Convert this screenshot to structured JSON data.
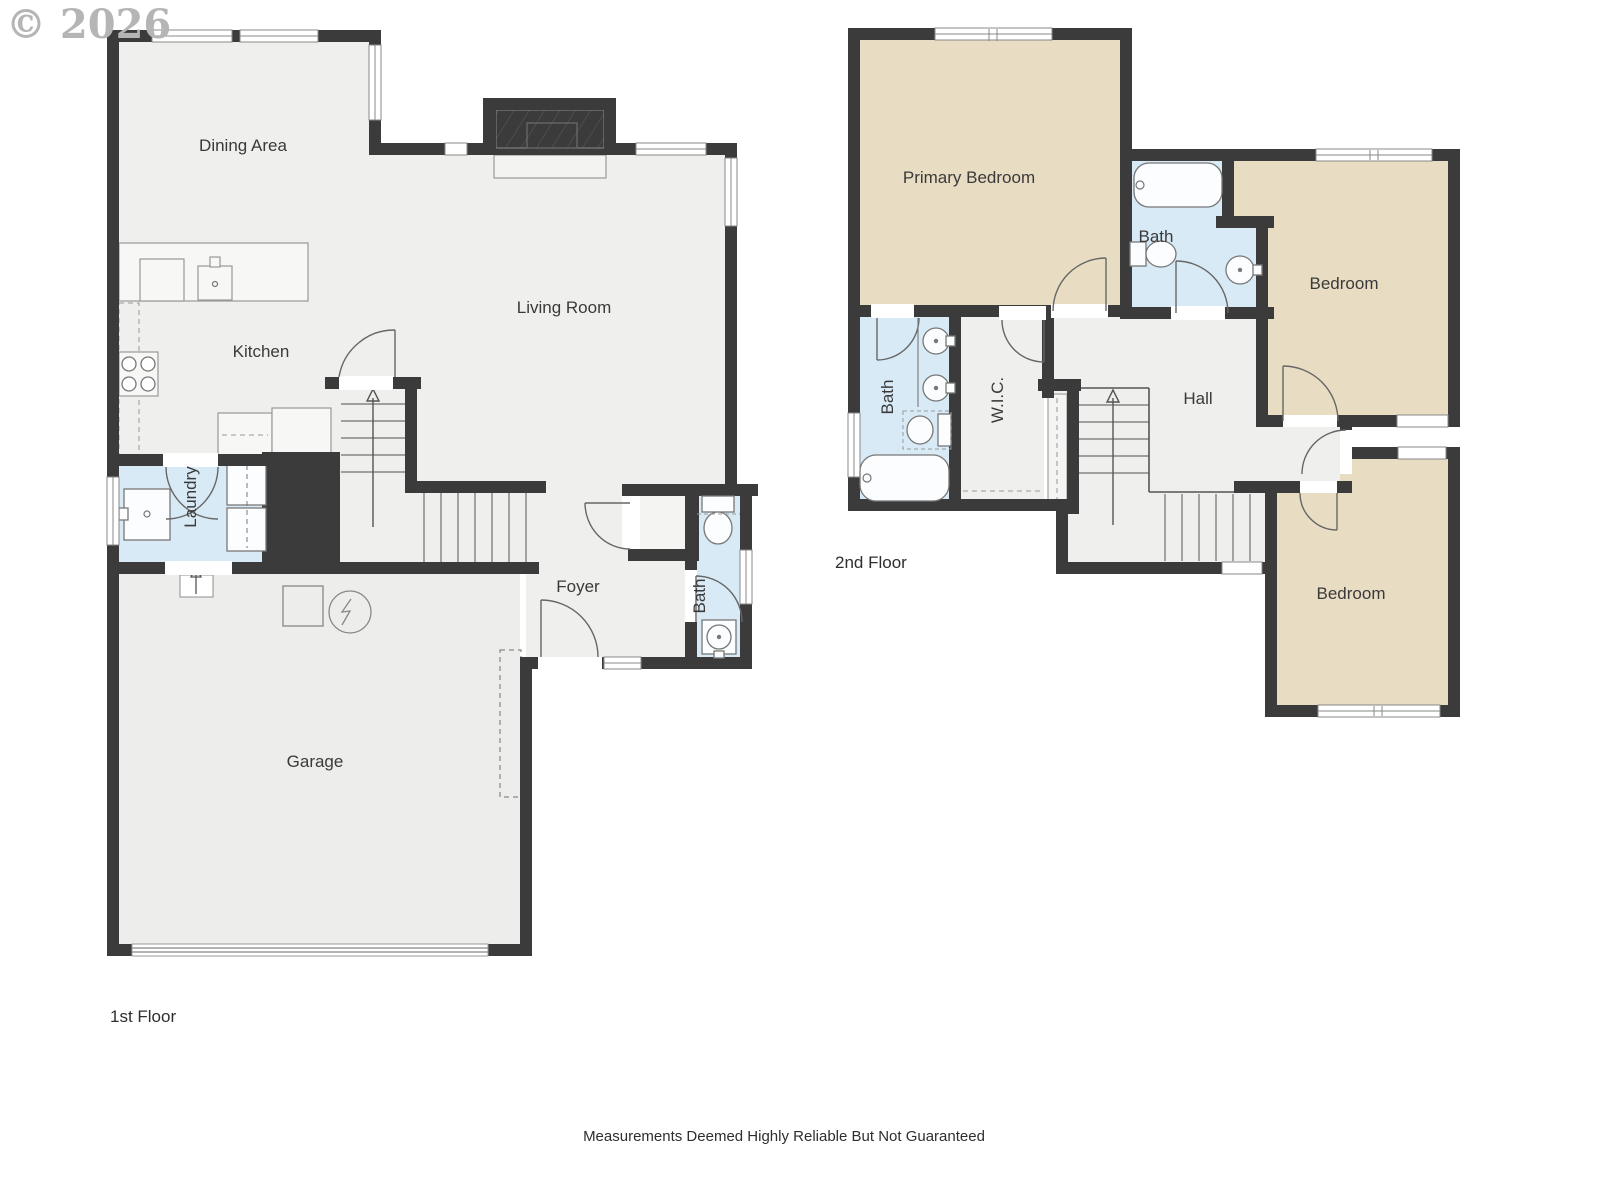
{
  "copyright": "© 2026",
  "floors": {
    "floor1": {
      "label": "1st Floor",
      "rooms": {
        "dining": "Dining Area",
        "kitchen": "Kitchen",
        "living": "Living Room",
        "laundry": "Laundry",
        "foyer": "Foyer",
        "bath": "Bath",
        "garage": "Garage"
      }
    },
    "floor2": {
      "label": "2nd Floor",
      "rooms": {
        "primary": "Primary Bedroom",
        "bath_hall": "Bath",
        "bedroom_top": "Bedroom",
        "bath_primary": "Bath",
        "wic": "W.I.C.",
        "hall": "Hall",
        "bedroom_bottom": "Bedroom"
      }
    }
  },
  "footer": {
    "disclaimer": "Measurements Deemed Highly Reliable But Not Guaranteed"
  },
  "palette": {
    "wall": "#3b3b3b",
    "floor": "#efefed",
    "garage_floor": "#ededeb",
    "bath_blue": "#d9eaf7",
    "bedroom_tan": "#e8dcc3",
    "fixture_line": "#777777",
    "door_arc": "#666666",
    "label_text": "#3a3a3a",
    "copyright_gray": "#b5b5b5"
  }
}
